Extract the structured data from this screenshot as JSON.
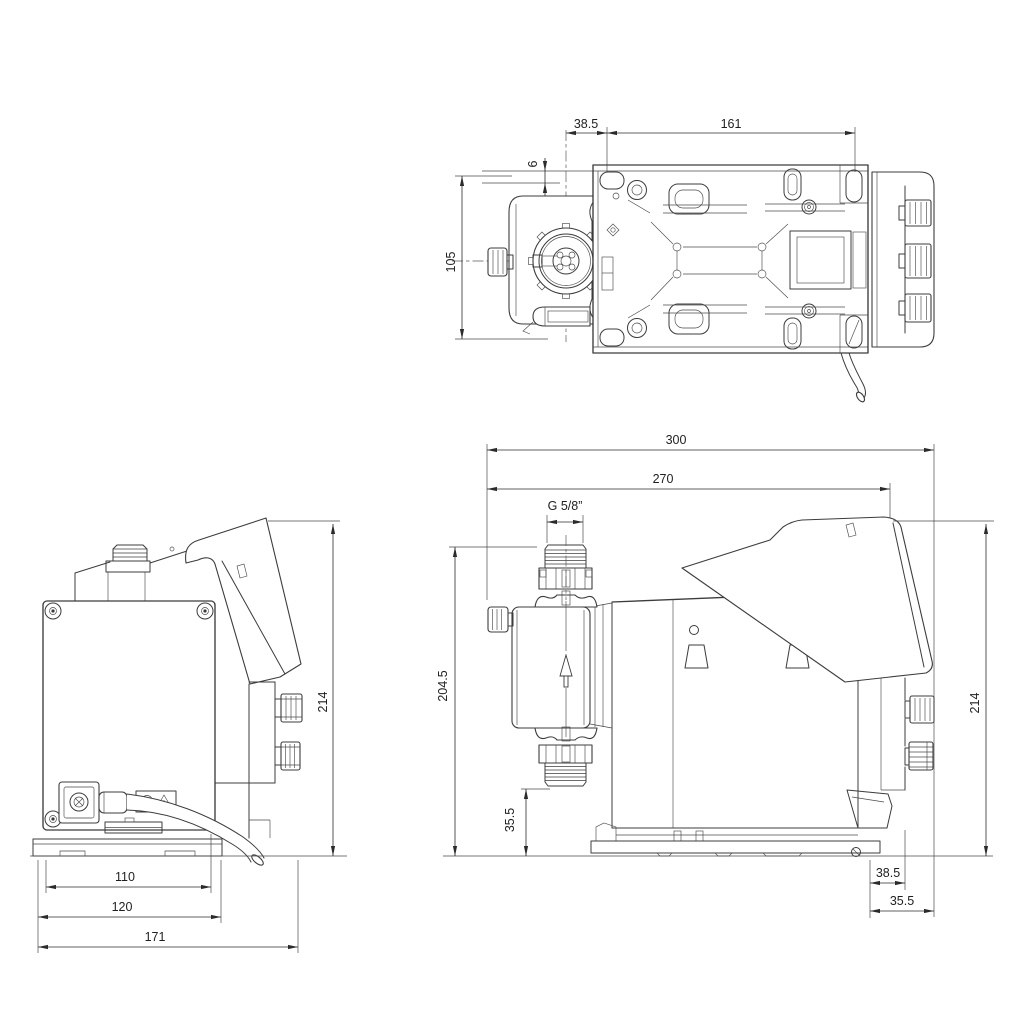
{
  "page": {
    "background": "#ffffff"
  },
  "drawing": {
    "type": "technical-dimensional-drawing",
    "subject": "diaphragm dosing pump, three orthographic views with dimensions (mm)",
    "line_color": "#3c3c3c",
    "dim_color": "#1f1f1f",
    "views": {
      "top": {
        "label": "top view",
        "dims": {
          "d38_5": "38.5",
          "d161": "161",
          "d6": "6",
          "d105": "105"
        }
      },
      "front": {
        "label": "front view",
        "dims": {
          "d110": "110",
          "d120": "120",
          "d171": "171",
          "d214": "214"
        }
      },
      "side": {
        "label": "side view",
        "dims": {
          "d300": "300",
          "d270": "270",
          "thread": "G 5/8”",
          "d204_5": "204.5",
          "d35_5_a": "35.5",
          "d214": "214",
          "d38_5": "38.5",
          "d35_5_b": "35.5"
        }
      }
    }
  }
}
